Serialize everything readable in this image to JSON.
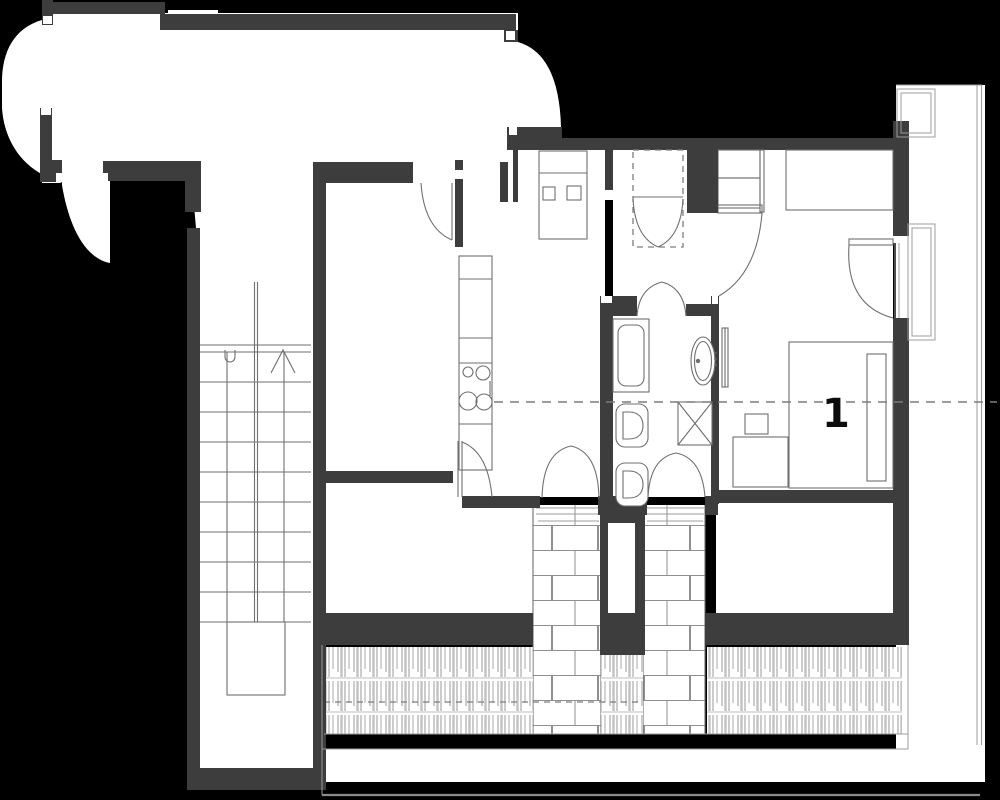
{
  "document": {
    "title": "Apartment floor plan",
    "drawing_type": "architectural plan with balcony section"
  },
  "labels": {
    "section_mark": "1"
  },
  "colors": {
    "background": "#000000",
    "wall": "#3d3d3d",
    "room": "#ffffff",
    "line": "#6f6f6f",
    "line_light": "#9c9c9c",
    "dashed": "#7d7d7d",
    "label": "#0d0d0d"
  },
  "elements": {
    "stairs": {
      "direction_icon": "up-arrow",
      "flights": 2
    },
    "fixtures": [
      "kitchen-counter",
      "stove-4-burners",
      "bathtub",
      "toilet",
      "bidet",
      "washbasin",
      "ventilation-shaft",
      "radiator"
    ],
    "furniture": [
      "wardrobe",
      "desk",
      "cabinet",
      "bed",
      "nightstand",
      "dresser"
    ],
    "doors": [
      "entry-door",
      "living-room-door",
      "kitchen-balcony-double-door",
      "bathroom-double-door",
      "bedroom-door",
      "balcony-french-door"
    ],
    "outdoor": [
      "balcony-railing-shingles",
      "tiled-path",
      "brick-steps",
      "garden-edge-lines"
    ]
  }
}
